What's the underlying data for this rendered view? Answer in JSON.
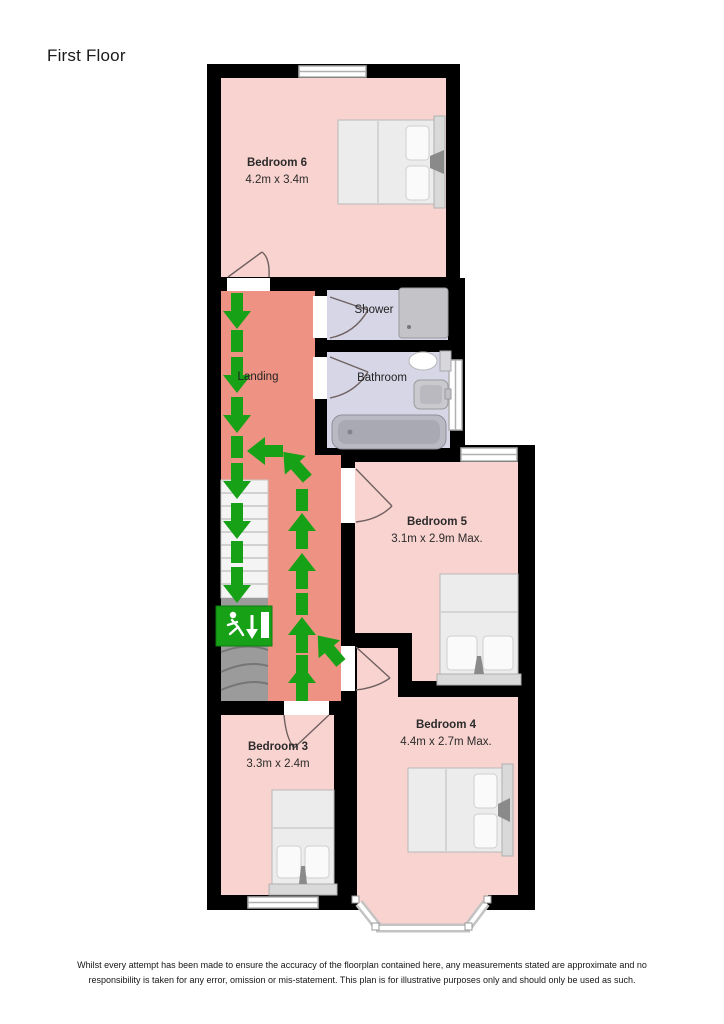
{
  "title": "First Floor",
  "rooms": {
    "bedroom6": {
      "name": "Bedroom 6",
      "dims": "4.2m x 3.4m"
    },
    "landing": {
      "name": "Landing"
    },
    "shower": {
      "name": "Shower"
    },
    "bathroom": {
      "name": "Bathroom"
    },
    "bedroom5": {
      "name": "Bedroom 5",
      "dims": "3.1m x 2.9m Max."
    },
    "bedroom4": {
      "name": "Bedroom 4",
      "dims": "4.4m x 2.7m Max."
    },
    "bedroom3": {
      "name": "Bedroom 3",
      "dims": "3.3m x 2.4m"
    }
  },
  "colors": {
    "wall": "#000000",
    "bedroom_fill": "#f9d3cf",
    "landing_fill": "#ee9383",
    "bathroom_fill": "#d6d6e6",
    "escape_route_green": "#17a117",
    "exit_sign_green": "#17a117"
  },
  "disclaimer": "Whilst every attempt has been made to ensure the accuracy of the floorplan contained here, any measurements stated are approximate and no responsibility is taken for any error, omission or mis-statement. This plan is for illustrative purposes only and should only be used as such."
}
